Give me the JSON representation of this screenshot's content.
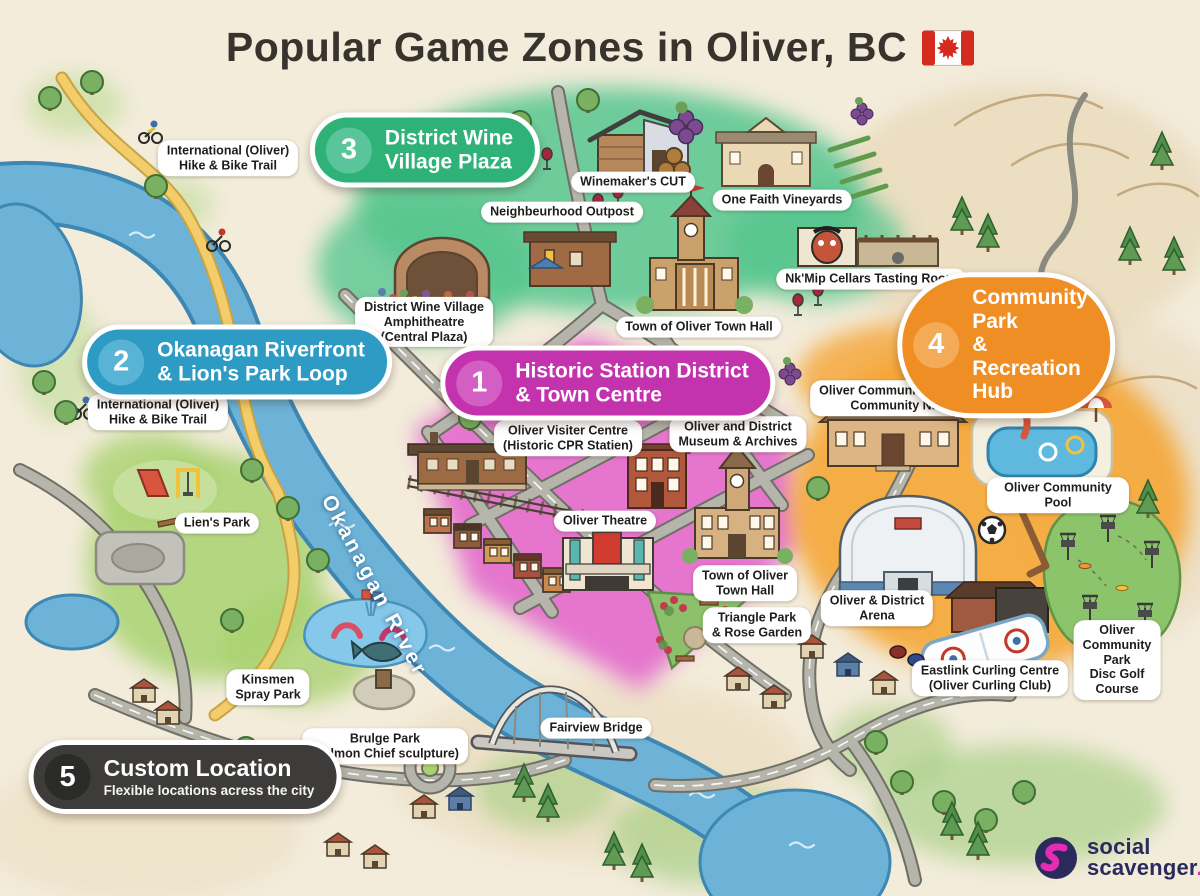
{
  "title": {
    "text": "Popular Game Zones in Oliver, BC",
    "flag_icon": "canada-flag"
  },
  "zones": [
    {
      "num": "1",
      "name": "Historic Station District\n& Town Centre",
      "color": "#c433ae",
      "num_bg": "#d45fc4"
    },
    {
      "num": "2",
      "name": "Okanagan Riverfront\n& Lion's Park Loop",
      "color": "#2e9bc5",
      "num_bg": "#58b3d4"
    },
    {
      "num": "3",
      "name": "District Wine\nVillage Plaza",
      "color": "#2fb278",
      "num_bg": "#5ac59a"
    },
    {
      "num": "4",
      "name": "Community Park\n& Recreation Hub",
      "color": "#f08e26",
      "num_bg": "#f4ab57"
    },
    {
      "num": "5",
      "name": "Custom Location",
      "subtitle": "Flexible locations acress the city",
      "color": "#3d3c3a",
      "num_bg": "#2b2b29"
    }
  ],
  "labels": {
    "trail_top": "International (Oliver)\nHike & Bike Trail",
    "winemakers_cut": "Winemaker's CUT",
    "neighbourhood_outpost": "Neighbeurhood Outpost",
    "one_faith": "One Faith Vineyards",
    "nkmip": "Nk'Mip Cellars Tasting Room",
    "amphitheatre": "District Wine Village\nAmphitheatre\n(Central Plaza)",
    "town_hall_wine": "Town of Oliver Town Hall",
    "trail_left": "International (Oliver)\nHike & Bike Trail",
    "visitor_centre": "Oliver Visiter Centre\n(Historic CPR Statien)",
    "museum": "Oliver and District\nMuseum & Archives",
    "community_centre": "Oliver Community Centre /\nCommunity Nall",
    "lions_park": "Lien's Park",
    "theatre": "Oliver Theatre",
    "pool": "Oliver Community Pool",
    "town_hall_centre": "Town of Oliver\nTown Hall",
    "arena": "Oliver & District\nArena",
    "triangle_park": "Triangle Park\n& Rose Garden",
    "kinsmen": "Kinsmen\nSpray Park",
    "curling": "Eastlink Curling Centre\n(Oliver Curling Club)",
    "disc_golf": "Oliver Community Park\nDisc Golf Course",
    "bridge_park": "Brulge Park\n(Salmon Chief sculpture)",
    "fairview": "Fairview Bridge"
  },
  "river_label": "Okanagan River",
  "logo": {
    "word1": "social",
    "word2": "scavenger",
    "dot": "."
  },
  "palette": {
    "background": "#f3ecdb",
    "river": "#6db3d8",
    "river_edge": "#3d87b2",
    "zone_historic": "#c433ae",
    "zone_riverfront": "#2e9bc5",
    "zone_wine": "#2fb278",
    "zone_community": "#f08e26",
    "zone_custom": "#3d3c3a",
    "trail_yellow": "#f2cd69",
    "logo_navy": "#2b2a5c",
    "logo_magenta": "#e52cb4"
  }
}
